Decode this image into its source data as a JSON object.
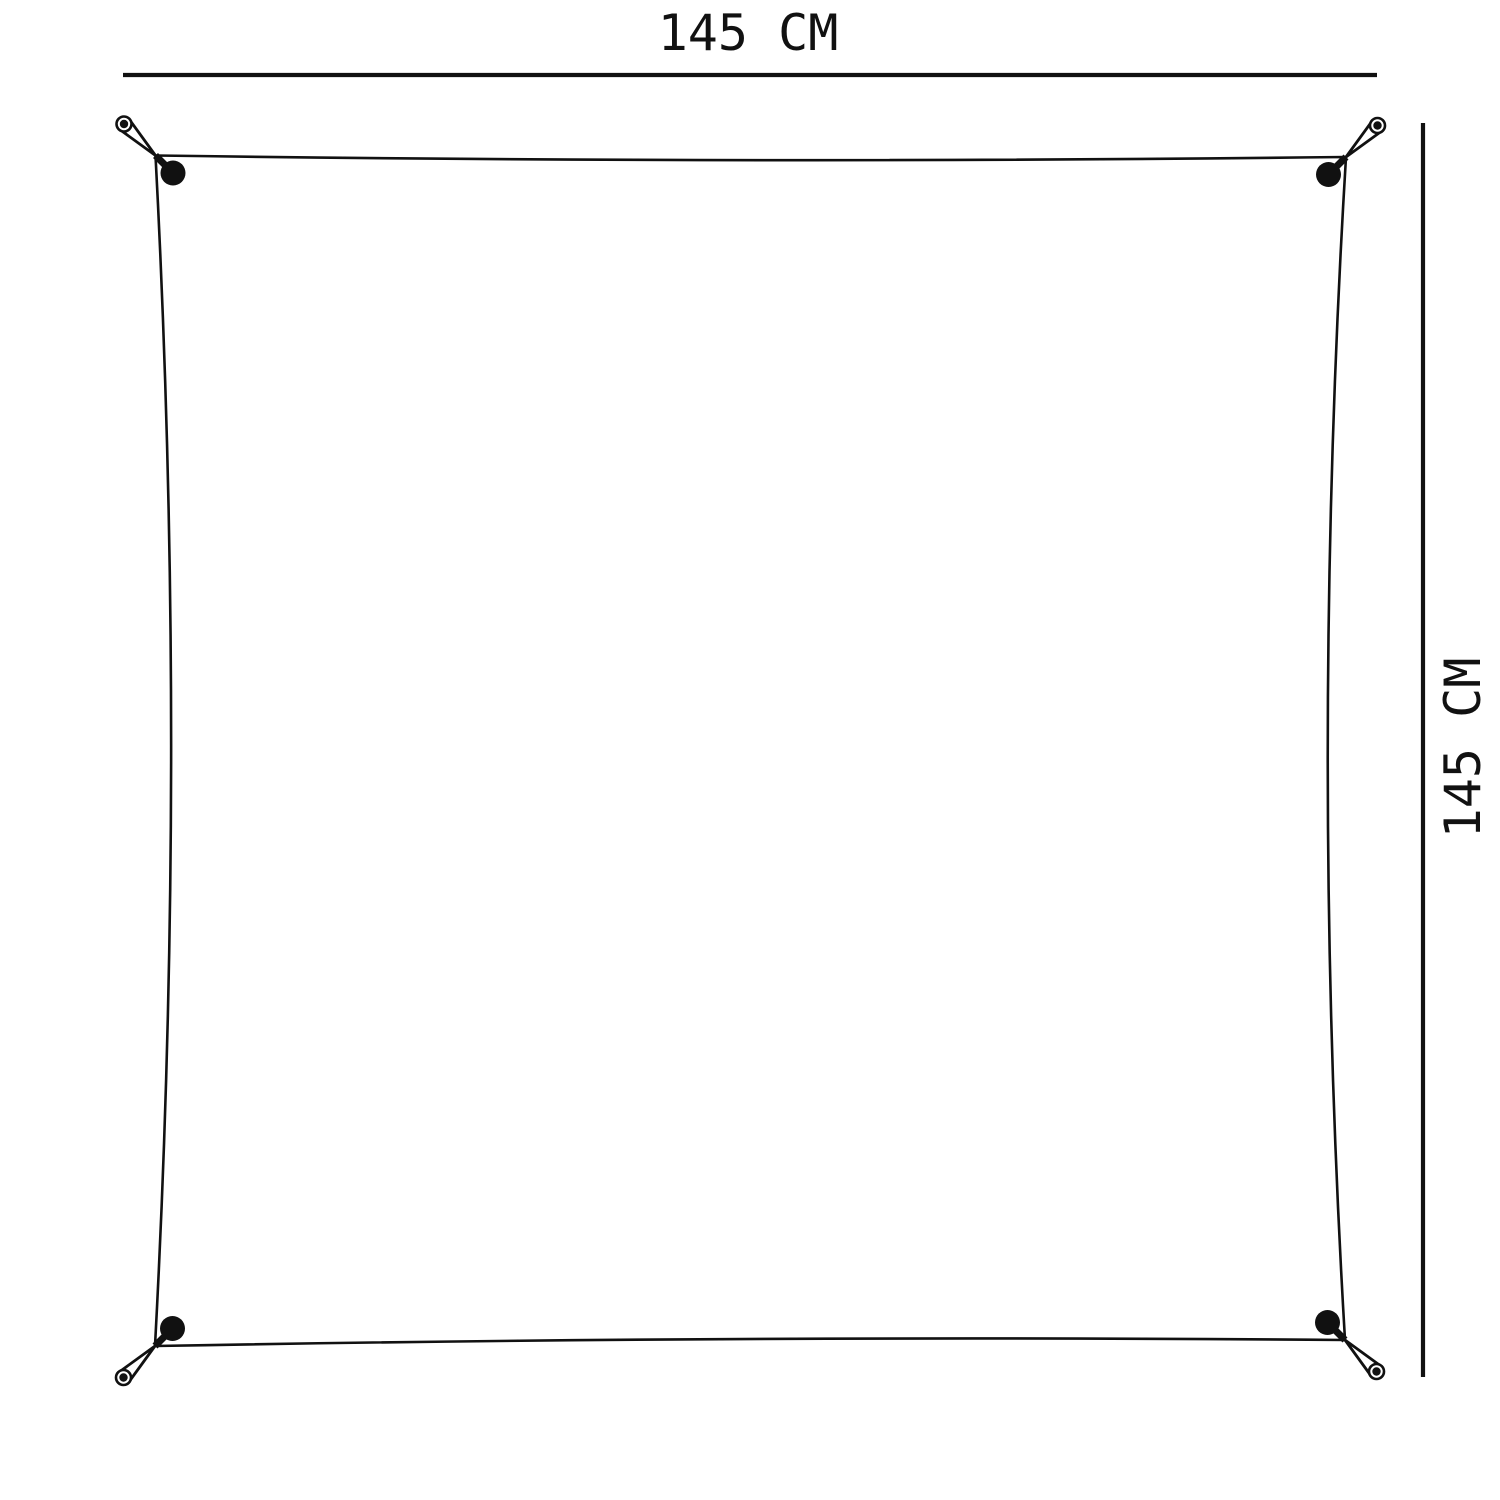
{
  "diagram": {
    "type": "product-dimension-diagram",
    "subject": "square sheet stretched and pegged at four corners",
    "width_label": "145 CM",
    "height_label": "145 CM"
  },
  "icons": {
    "corner_stakes": [
      "stake-icon-top-left",
      "stake-icon-top-right",
      "stake-icon-bottom-right",
      "stake-icon-bottom-left"
    ],
    "grommet": "grommet-dot-icon"
  },
  "colors": {
    "line": "#111111",
    "background": "#ffffff"
  }
}
